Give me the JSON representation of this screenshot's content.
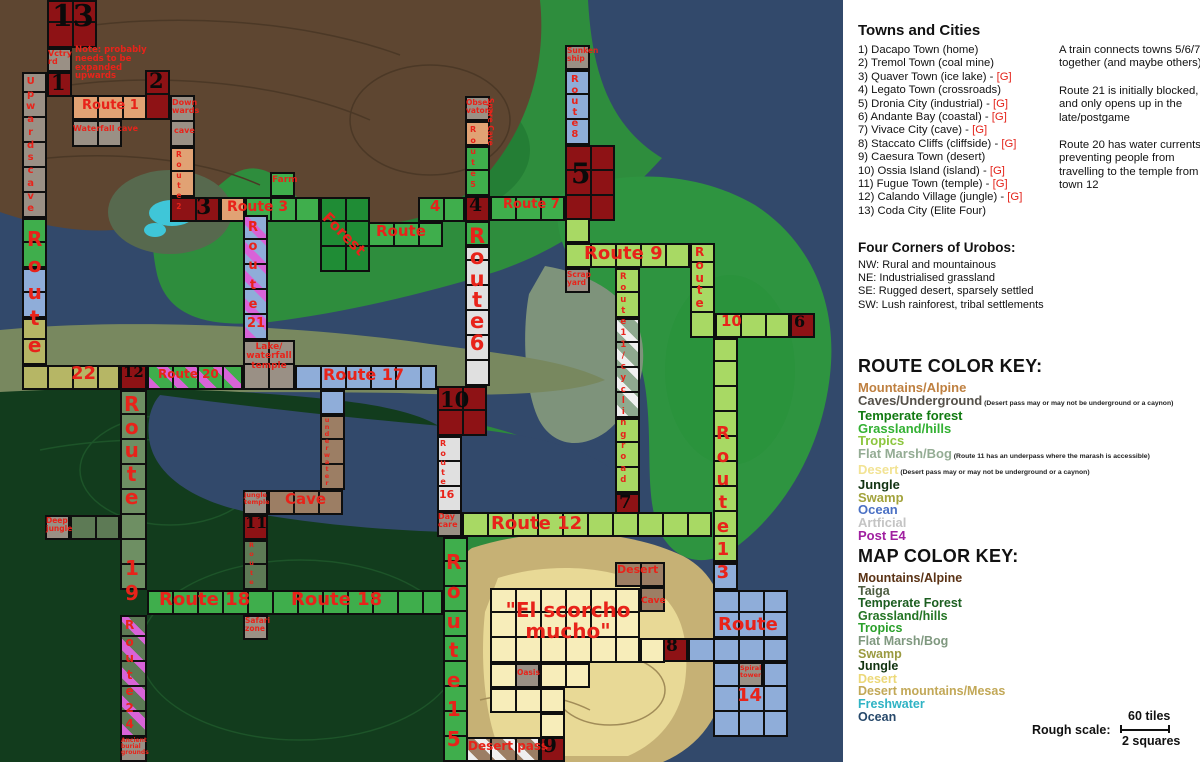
{
  "legend": {
    "towns_title": "Towns and Cities",
    "towns": [
      {
        "label": "1) Dacapo Town (home)",
        "gym": false
      },
      {
        "label": "2) Tremol Town (coal mine)",
        "gym": false
      },
      {
        "label": "3) Quaver Town (ice lake)",
        "gym": true
      },
      {
        "label": "4) Legato Town (crossroads)",
        "gym": false
      },
      {
        "label": "5) Dronia City (industrial)",
        "gym": true
      },
      {
        "label": "6) Andante Bay (coastal)",
        "gym": true
      },
      {
        "label": "7) Vivace City (cave)",
        "gym": true
      },
      {
        "label": "8) Staccato Cliffs (cliffside)",
        "gym": true
      },
      {
        "label": "9) Caesura Town (desert)",
        "gym": false
      },
      {
        "label": "10) Ossia Island (island)",
        "gym": true
      },
      {
        "label": "11) Fugue Town (temple)",
        "gym": true
      },
      {
        "label": "12) Calando Village (jungle)",
        "gym": true
      },
      {
        "label": "13) Coda City (Elite Four)",
        "gym": false
      }
    ],
    "gym_marker": "[G]",
    "notes": [
      "A train connects towns 5/6/7 together (and maybe others)",
      "Route 21 is initially blocked, and only opens up in the late/postgame",
      "Route 20 has water currents preventing people from travelling to the temple from town 12"
    ],
    "corners_title": "Four Corners of Urobos:",
    "corners": [
      "NW: Rural and mountainous",
      "NE:  Industrialised grassland",
      "SE:  Rugged desert, sparsely settled",
      "SW: Lush rainforest, tribal settlements"
    ],
    "route_key_title": "ROUTE COLOR KEY:",
    "route_key": [
      {
        "label": "Mountains/Alpine",
        "color": "#bf8040",
        "note": ""
      },
      {
        "label": "Caves/Underground",
        "color": "#55514a",
        "note": "(Desert pass may or may not be underground or a caynon)"
      },
      {
        "label": "Temperate forest",
        "color": "#117a11",
        "note": ""
      },
      {
        "label": "Grassland/hills",
        "color": "#33b133",
        "note": ""
      },
      {
        "label": "Tropics",
        "color": "#8cc63e",
        "note": ""
      },
      {
        "label": "Flat Marsh/Bog",
        "color": "#94ac94",
        "note": "(Route 11 has an underpass where the marash is accessible)"
      },
      {
        "label": "Desert",
        "color": "#f2e394",
        "note": "(Desert pass may or may not be underground or a caynon)"
      },
      {
        "label": "Jungle",
        "color": "#123312",
        "note": ""
      },
      {
        "label": "Swamp",
        "color": "#a3a33c",
        "note": ""
      },
      {
        "label": "Ocean",
        "color": "#4a70c4",
        "note": ""
      },
      {
        "label": "Artficial",
        "color": "#c4c4c4",
        "note": ""
      },
      {
        "label": "Post E4",
        "color": "#a020a0",
        "note": ""
      }
    ],
    "map_key_title": "MAP COLOR KEY:",
    "map_key": [
      {
        "label": "Mountains/Alpine",
        "color": "#5a3214},",
        "c2": "#5a3214"
      },
      {
        "label": "Taiga",
        "color": "#4e5e42"
      },
      {
        "label": "Temperate Forest",
        "color": "#1c5e20"
      },
      {
        "label": "Grassland/hills",
        "color": "#247524"
      },
      {
        "label": "Tropics",
        "color": "#2ba02b"
      },
      {
        "label": "Flat Marsh/Bog",
        "color": "#7f987f"
      },
      {
        "label": "Swamp",
        "color": "#9a9a40"
      },
      {
        "label": "Jungle",
        "color": "#11330f"
      },
      {
        "label": "Desert",
        "color": "#ecd878"
      },
      {
        "label": "Desert mountains/Mesas",
        "color": "#c2a857"
      },
      {
        "label": "Freshwater",
        "color": "#2fb3c4"
      },
      {
        "label": "Ocean",
        "color": "#27496b"
      }
    ],
    "scale_label": "Rough scale:",
    "scale_top": "60 tiles",
    "scale_bottom": "2 squares"
  },
  "map": {
    "tile_colors": {
      "town": "#8e1215",
      "alpine": "#e1a274",
      "cave": "#9a9085",
      "grass": "#3fae4c",
      "forest": "#1f8c35",
      "tropics": "#a8d964",
      "marsh": "#8fa98f",
      "oceanRoute": "#8fadd9",
      "artificial": "#e0e0e0",
      "swamp": "#b6b665",
      "jungleRoute": "#5d7a55",
      "route19": "#6e8f63",
      "mesa": "#9c7e64",
      "desert": "#f7edba",
      "stripe_pink": "#d863d8",
      "stripe_white": "#efefef"
    },
    "tiles": [
      [
        47,
        0,
        50,
        48,
        "town"
      ],
      [
        47,
        48,
        25,
        24,
        "cave"
      ],
      [
        22,
        72,
        25,
        146,
        "cave"
      ],
      [
        47,
        72,
        25,
        25,
        "town"
      ],
      [
        145,
        70,
        25,
        50,
        "town"
      ],
      [
        72,
        95,
        75,
        25,
        "alpine"
      ],
      [
        72,
        120,
        50,
        27,
        "cave"
      ],
      [
        170,
        95,
        25,
        52,
        "cave"
      ],
      [
        170,
        147,
        25,
        50,
        "alpine"
      ],
      [
        170,
        197,
        50,
        25,
        "town"
      ],
      [
        220,
        197,
        25,
        25,
        "alpine"
      ],
      [
        245,
        197,
        75,
        25,
        "grass"
      ],
      [
        270,
        172,
        25,
        25,
        "grass"
      ],
      [
        320,
        197,
        50,
        75,
        "forest"
      ],
      [
        368,
        222,
        75,
        25,
        "grass"
      ],
      [
        418,
        197,
        47,
        25,
        "grass"
      ],
      [
        465,
        196,
        25,
        26,
        "town"
      ],
      [
        465,
        96,
        25,
        25,
        "cave"
      ],
      [
        465,
        121,
        25,
        25,
        "alpine"
      ],
      [
        465,
        146,
        25,
        50,
        "grass"
      ],
      [
        490,
        196,
        75,
        25,
        "grass"
      ],
      [
        565,
        145,
        50,
        76,
        "town"
      ],
      [
        565,
        45,
        25,
        25,
        "cave"
      ],
      [
        565,
        70,
        25,
        75,
        "oceanRoute"
      ],
      [
        465,
        221,
        25,
        25,
        "grass"
      ],
      [
        465,
        246,
        25,
        140,
        "artificial"
      ],
      [
        437,
        386,
        50,
        50,
        "town"
      ],
      [
        565,
        218,
        25,
        25,
        "tropics"
      ],
      [
        565,
        243,
        125,
        25,
        "tropics"
      ],
      [
        565,
        268,
        25,
        25,
        "cave"
      ],
      [
        690,
        243,
        25,
        95,
        "tropics"
      ],
      [
        715,
        313,
        75,
        25,
        "tropics"
      ],
      [
        790,
        313,
        25,
        25,
        "town"
      ],
      [
        615,
        268,
        25,
        50,
        "tropics"
      ],
      [
        615,
        318,
        25,
        100,
        "marsh",
        "white"
      ],
      [
        615,
        418,
        25,
        75,
        "tropics"
      ],
      [
        615,
        493,
        25,
        25,
        "town"
      ],
      [
        713,
        338,
        25,
        224,
        "tropics"
      ],
      [
        713,
        562,
        25,
        28,
        "oceanRoute"
      ],
      [
        713,
        590,
        75,
        48,
        "oceanRoute"
      ],
      [
        688,
        638,
        100,
        24,
        "oceanRoute"
      ],
      [
        713,
        662,
        75,
        75,
        "oceanRoute"
      ],
      [
        738,
        662,
        25,
        25,
        "cave"
      ],
      [
        663,
        638,
        25,
        24,
        "town"
      ],
      [
        490,
        588,
        150,
        75,
        "desert"
      ],
      [
        490,
        663,
        100,
        25,
        "desert"
      ],
      [
        515,
        663,
        25,
        25,
        "cave"
      ],
      [
        490,
        688,
        75,
        25,
        "desert"
      ],
      [
        540,
        713,
        25,
        25,
        "desert"
      ],
      [
        640,
        638,
        25,
        25,
        "desert"
      ],
      [
        615,
        562,
        50,
        25,
        "mesa"
      ],
      [
        640,
        587,
        25,
        25,
        "mesa"
      ],
      [
        465,
        737,
        75,
        25,
        "mesa",
        "white"
      ],
      [
        540,
        737,
        25,
        25,
        "town"
      ],
      [
        443,
        537,
        25,
        225,
        "grass"
      ],
      [
        462,
        512,
        250,
        25,
        "tropics"
      ],
      [
        437,
        436,
        25,
        76,
        "artificial"
      ],
      [
        437,
        512,
        25,
        25,
        "cave"
      ],
      [
        295,
        365,
        142,
        25,
        "oceanRoute"
      ],
      [
        243,
        340,
        52,
        50,
        "cave"
      ],
      [
        243,
        215,
        25,
        125,
        "oceanRoute",
        "pink"
      ],
      [
        320,
        390,
        25,
        25,
        "oceanRoute"
      ],
      [
        320,
        415,
        25,
        75,
        "mesa"
      ],
      [
        243,
        490,
        25,
        25,
        "cave"
      ],
      [
        268,
        490,
        75,
        25,
        "mesa"
      ],
      [
        243,
        515,
        25,
        25,
        "town"
      ],
      [
        243,
        540,
        25,
        50,
        "jungleRoute"
      ],
      [
        243,
        615,
        25,
        25,
        "cave"
      ],
      [
        147,
        590,
        296,
        25,
        "grass"
      ],
      [
        120,
        390,
        27,
        200,
        "route19"
      ],
      [
        45,
        515,
        25,
        25,
        "cave"
      ],
      [
        70,
        515,
        50,
        25,
        "jungleRoute"
      ],
      [
        120,
        615,
        27,
        122,
        "jungleRoute",
        "pink"
      ],
      [
        120,
        737,
        27,
        25,
        "cave"
      ],
      [
        22,
        218,
        25,
        50,
        "grass"
      ],
      [
        22,
        268,
        25,
        50,
        "oceanRoute"
      ],
      [
        22,
        318,
        25,
        47,
        "swamp"
      ],
      [
        22,
        365,
        98,
        25,
        "swamp"
      ],
      [
        120,
        365,
        27,
        25,
        "town"
      ],
      [
        147,
        365,
        96,
        25,
        "grass",
        "pink"
      ]
    ],
    "labels": [
      {
        "x": 52,
        "y": 2,
        "t": "13",
        "s": 30,
        "c": "#0a0a0a",
        "f": 1
      },
      {
        "x": 48,
        "y": 50,
        "t": "Vctry\nrd",
        "s": 8
      },
      {
        "x": 75,
        "y": 46,
        "t": "Note: probably\nneeds to be\nexpanded\nupwards",
        "s": 8.5
      },
      {
        "x": 26,
        "y": 76,
        "t": "Upwards cave",
        "s": 10,
        "st": 140
      },
      {
        "x": 51,
        "y": 72,
        "t": "1",
        "s": 21,
        "c": "#0a0a0a",
        "f": 1
      },
      {
        "x": 149,
        "y": 70,
        "t": "2",
        "s": 21,
        "c": "#0a0a0a",
        "f": 1
      },
      {
        "x": 82,
        "y": 99,
        "t": "Route 1",
        "s": 13
      },
      {
        "x": 73,
        "y": 125,
        "t": "Waterfall cave",
        "s": 8
      },
      {
        "x": 172,
        "y": 99,
        "t": "Down\nwards",
        "s": 8
      },
      {
        "x": 174,
        "y": 127,
        "t": "cave",
        "s": 8
      },
      {
        "x": 176,
        "y": 150,
        "t": "Route 2",
        "s": 7.5,
        "st": 62
      },
      {
        "x": 196,
        "y": 196,
        "t": "3",
        "s": 22,
        "c": "#0a0a0a",
        "f": 1
      },
      {
        "x": 227,
        "y": 200,
        "t": "Route 3",
        "s": 14
      },
      {
        "x": 272,
        "y": 176,
        "t": "Farm",
        "s": 9
      },
      {
        "x": 330,
        "y": 210,
        "t": "Forest",
        "s": 15,
        "r": 45
      },
      {
        "x": 376,
        "y": 224,
        "t": "Route",
        "s": 15
      },
      {
        "x": 430,
        "y": 199,
        "t": "4",
        "s": 15
      },
      {
        "x": 469,
        "y": 196,
        "t": "4",
        "s": 19,
        "c": "#0a0a0a",
        "f": 1
      },
      {
        "x": 466,
        "y": 99,
        "t": "Obser\nvatory",
        "s": 7.5
      },
      {
        "x": 494,
        "y": 98,
        "t": "Spare Cave",
        "s": 7.5,
        "r": 90
      },
      {
        "x": 470,
        "y": 124,
        "t": "Route 5",
        "s": 8,
        "st": 66
      },
      {
        "x": 503,
        "y": 198,
        "t": "Route 7",
        "s": 13
      },
      {
        "x": 571,
        "y": 160,
        "t": "5",
        "s": 28,
        "c": "#0a0a0a",
        "f": 1
      },
      {
        "x": 567,
        "y": 47,
        "t": "Sunken\nship",
        "s": 7.5
      },
      {
        "x": 571,
        "y": 74,
        "t": "Route 8",
        "s": 10,
        "st": 66
      },
      {
        "x": 469,
        "y": 226,
        "t": "Route 6",
        "s": 21,
        "st": 128
      },
      {
        "x": 440,
        "y": 389,
        "t": "10",
        "s": 21,
        "c": "#0a0a0a",
        "f": 1
      },
      {
        "x": 584,
        "y": 245,
        "t": "Route 9",
        "s": 18
      },
      {
        "x": 567,
        "y": 271,
        "t": "Scrap\nyard",
        "s": 7.5
      },
      {
        "x": 695,
        "y": 246,
        "t": "Route",
        "s": 12,
        "st": 64
      },
      {
        "x": 721,
        "y": 314,
        "t": "10",
        "s": 15
      },
      {
        "x": 794,
        "y": 314,
        "t": "6",
        "s": 16,
        "c": "#0a0a0a",
        "f": 1
      },
      {
        "x": 620,
        "y": 272,
        "t": "Route 11 /cycling road",
        "s": 8.5,
        "st": 214
      },
      {
        "x": 619,
        "y": 494,
        "t": "7",
        "s": 18,
        "c": "#0a0a0a",
        "f": 1
      },
      {
        "x": 716,
        "y": 422,
        "t": "Route 13",
        "s": 18,
        "st": 162
      },
      {
        "x": 718,
        "y": 616,
        "t": "Route",
        "s": 18
      },
      {
        "x": 737,
        "y": 687,
        "t": "14",
        "s": 18
      },
      {
        "x": 740,
        "y": 665,
        "t": "Spiral\ntower",
        "s": 6.5
      },
      {
        "x": 666,
        "y": 638,
        "t": "8",
        "s": 17,
        "c": "#0a0a0a",
        "f": 1
      },
      {
        "x": 503,
        "y": 600,
        "t": "\"El scorcho\nmucho\"",
        "s": 20,
        "w": 130,
        "ta": "center"
      },
      {
        "x": 517,
        "y": 669,
        "t": "Oasis",
        "s": 7.5
      },
      {
        "x": 617,
        "y": 564,
        "t": "Desert",
        "s": 11
      },
      {
        "x": 641,
        "y": 597,
        "t": "Cave",
        "s": 9
      },
      {
        "x": 468,
        "y": 740,
        "t": "Desert pass",
        "s": 12
      },
      {
        "x": 543,
        "y": 735,
        "t": "9",
        "s": 20,
        "c": "#0a0a0a",
        "f": 1
      },
      {
        "x": 446,
        "y": 548,
        "t": "Route 15",
        "s": 20,
        "st": 206
      },
      {
        "x": 491,
        "y": 515,
        "t": "Route 12",
        "s": 18
      },
      {
        "x": 440,
        "y": 439,
        "t": "Route",
        "s": 8,
        "st": 48
      },
      {
        "x": 439,
        "y": 489,
        "t": "16",
        "s": 11
      },
      {
        "x": 438,
        "y": 513,
        "t": "Day\ncare",
        "s": 8
      },
      {
        "x": 323,
        "y": 367,
        "t": "Route 17",
        "s": 16
      },
      {
        "x": 243,
        "y": 343,
        "t": "Lake/\nwaterfall\ntemple",
        "s": 9,
        "w": 52,
        "ta": "center"
      },
      {
        "x": 248,
        "y": 218,
        "t": "Route",
        "s": 13,
        "st": 96
      },
      {
        "x": 247,
        "y": 317,
        "t": "21",
        "s": 13
      },
      {
        "x": 324,
        "y": 417,
        "t": "underwater",
        "s": 6.5,
        "st": 70
      },
      {
        "x": 285,
        "y": 492,
        "t": "Cave",
        "s": 15
      },
      {
        "x": 244,
        "y": 492,
        "t": "Jungle\ntemple",
        "s": 6.5
      },
      {
        "x": 245,
        "y": 515,
        "t": "11",
        "s": 16,
        "c": "#0a0a0a",
        "f": 1
      },
      {
        "x": 249,
        "y": 541,
        "t": "Route",
        "s": 6.5,
        "st": 46
      },
      {
        "x": 245,
        "y": 617,
        "t": "Safari\nzone",
        "s": 7.5
      },
      {
        "x": 159,
        "y": 591,
        "t": "Route 18",
        "s": 18
      },
      {
        "x": 291,
        "y": 591,
        "t": "Route 18",
        "s": 18
      },
      {
        "x": 124,
        "y": 393,
        "t": "Route",
        "s": 20,
        "st": 116
      },
      {
        "x": 125,
        "y": 556,
        "t": "19",
        "s": 20,
        "st": 50
      },
      {
        "x": 46,
        "y": 517,
        "t": "Deep\njungle",
        "s": 7.5
      },
      {
        "x": 125,
        "y": 617,
        "t": "Route 24",
        "s": 12,
        "st": 116
      },
      {
        "x": 121,
        "y": 738,
        "t": "Ancient\nburial\ngrounds",
        "s": 6
      },
      {
        "x": 27,
        "y": 226,
        "t": "Route",
        "s": 20,
        "st": 132
      },
      {
        "x": 71,
        "y": 365,
        "t": "22",
        "s": 18
      },
      {
        "x": 123,
        "y": 365,
        "t": "12",
        "s": 15,
        "c": "#0a0a0a",
        "f": 1
      },
      {
        "x": 158,
        "y": 368,
        "t": "Route 20",
        "s": 12
      }
    ]
  }
}
